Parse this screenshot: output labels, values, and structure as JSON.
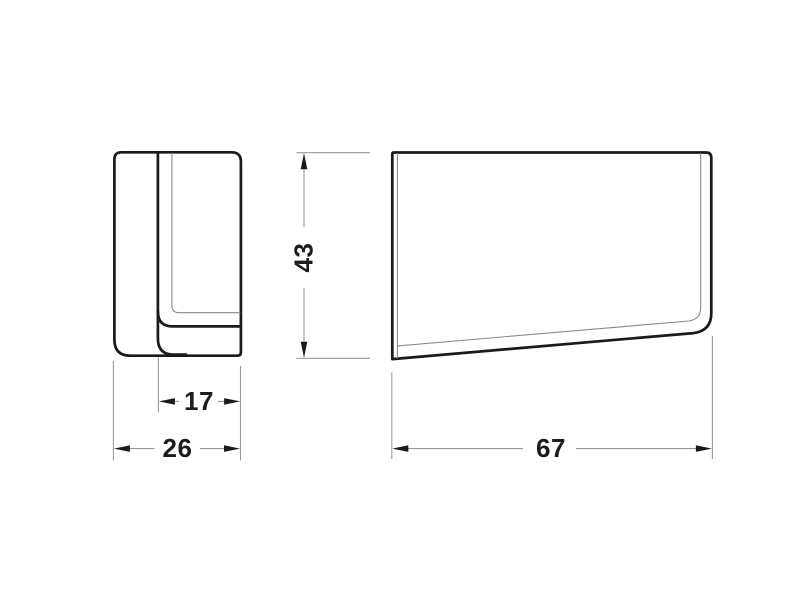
{
  "dimensions": {
    "height": "43",
    "inner_depth": "17",
    "depth": "26",
    "length": "67"
  },
  "colors": {
    "background": "#ffffff",
    "part_outline": "#1a1a1a",
    "thin_edge": "#8a8a8a",
    "dimension_line": "#9a9a9a",
    "dimension_text": "#1c1c1c"
  }
}
